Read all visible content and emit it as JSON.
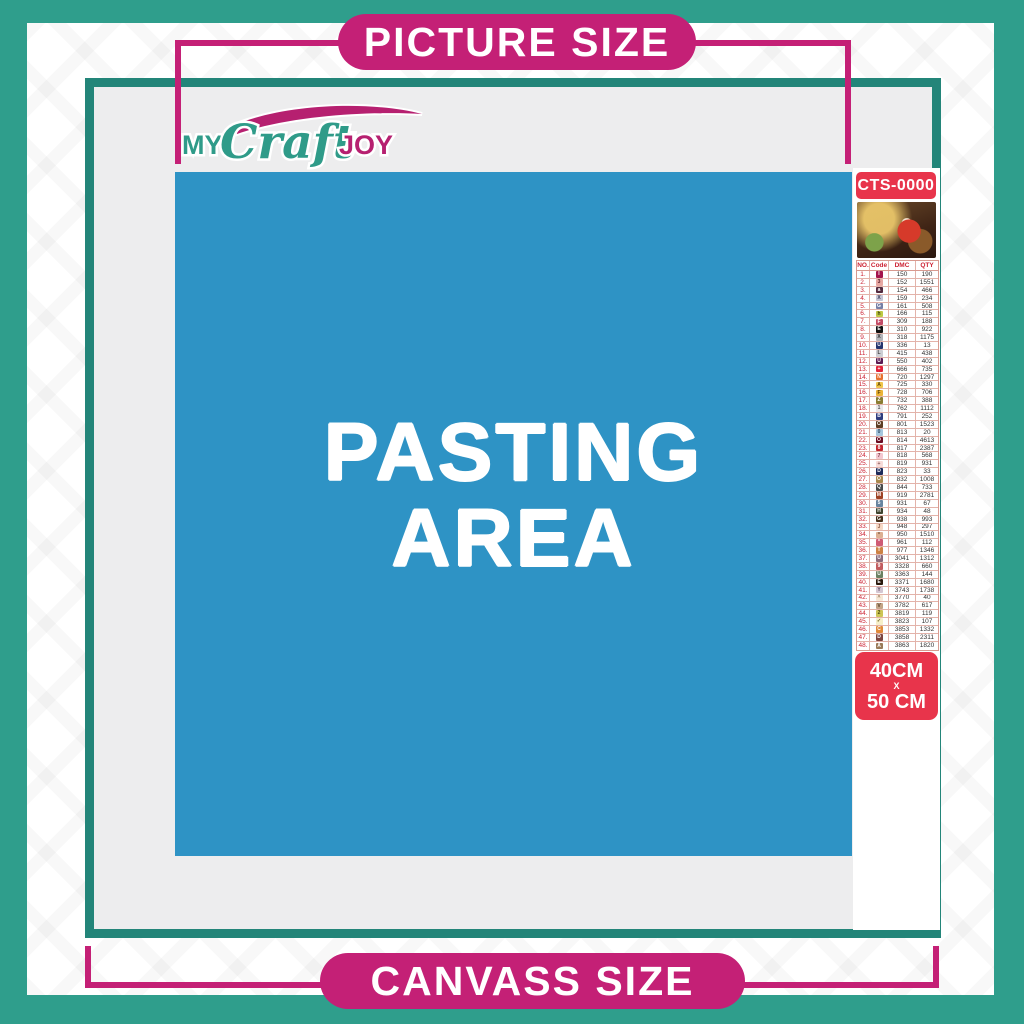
{
  "banners": {
    "top": "PICTURE SIZE",
    "bottom": "CANVASS SIZE"
  },
  "logo": {
    "word1": "MY",
    "word2": "Craft",
    "word3": "JOY"
  },
  "pasting_area": {
    "line1": "PASTING",
    "line2": "AREA"
  },
  "sidebar": {
    "product_code": "CTS-0000",
    "thumbnail": "santa-christmas-scene",
    "size_badge": {
      "line1": "40CM",
      "line2": "X",
      "line3": "50 CM"
    },
    "table": {
      "headers": [
        "NO.",
        "Code",
        "DMC",
        "QTY"
      ],
      "rows": [
        {
          "no": "1.",
          "symbol": "I",
          "cell_bg": "#a3154d",
          "sym_color": "#ffffff",
          "dmc": "150",
          "qty": "190"
        },
        {
          "no": "2.",
          "symbol": "3",
          "cell_bg": "#e8a7a2",
          "sym_color": "#5a2430",
          "dmc": "152",
          "qty": "1551"
        },
        {
          "no": "3.",
          "symbol": "a",
          "cell_bg": "#532a3f",
          "sym_color": "#ffffff",
          "dmc": "154",
          "qty": "466"
        },
        {
          "no": "4.",
          "symbol": "X",
          "cell_bg": "#c5c4d4",
          "sym_color": "#3a3a55",
          "dmc": "159",
          "qty": "234"
        },
        {
          "no": "5.",
          "symbol": "G",
          "cell_bg": "#767fa6",
          "sym_color": "#ffffff",
          "dmc": "161",
          "qty": "508"
        },
        {
          "no": "6.",
          "symbol": "h",
          "cell_bg": "#bec944",
          "sym_color": "#3c4010",
          "dmc": "166",
          "qty": "115"
        },
        {
          "no": "7.",
          "symbol": "F",
          "cell_bg": "#c34a65",
          "sym_color": "#ffffff",
          "dmc": "309",
          "qty": "188"
        },
        {
          "no": "8.",
          "symbol": "E",
          "cell_bg": "#111111",
          "sym_color": "#ffffff",
          "dmc": "310",
          "qty": "922"
        },
        {
          "no": "9.",
          "symbol": "X",
          "cell_bg": "#b3b3b8",
          "sym_color": "#333333",
          "dmc": "318",
          "qty": "1175"
        },
        {
          "no": "10.",
          "symbol": "U",
          "cell_bg": "#24356e",
          "sym_color": "#ffffff",
          "dmc": "336",
          "qty": "13"
        },
        {
          "no": "11.",
          "symbol": "L",
          "cell_bg": "#cdced3",
          "sym_color": "#444444",
          "dmc": "415",
          "qty": "438"
        },
        {
          "no": "12.",
          "symbol": "U",
          "cell_bg": "#5b1a52",
          "sym_color": "#ffffff",
          "dmc": "550",
          "qty": "402"
        },
        {
          "no": "13.",
          "symbol": "+",
          "cell_bg": "#e22339",
          "sym_color": "#ffffff",
          "dmc": "666",
          "qty": "735"
        },
        {
          "no": "14.",
          "symbol": "N",
          "cell_bg": "#e8702f",
          "sym_color": "#ffffff",
          "dmc": "720",
          "qty": "1297"
        },
        {
          "no": "15.",
          "symbol": "A",
          "cell_bg": "#f0c54b",
          "sym_color": "#5a430a",
          "dmc": "725",
          "qty": "330"
        },
        {
          "no": "16.",
          "symbol": "F",
          "cell_bg": "#ecb338",
          "sym_color": "#5a430a",
          "dmc": "728",
          "qty": "706"
        },
        {
          "no": "17.",
          "symbol": "Z",
          "cell_bg": "#8a7d33",
          "sym_color": "#ffffff",
          "dmc": "732",
          "qty": "388"
        },
        {
          "no": "18.",
          "symbol": "1",
          "cell_bg": "#e9e7ea",
          "sym_color": "#555555",
          "dmc": "762",
          "qty": "1112"
        },
        {
          "no": "19.",
          "symbol": "B",
          "cell_bg": "#2f3c7e",
          "sym_color": "#ffffff",
          "dmc": "791",
          "qty": "252"
        },
        {
          "no": "20.",
          "symbol": "O",
          "cell_bg": "#5e3d24",
          "sym_color": "#ffffff",
          "dmc": "801",
          "qty": "1523"
        },
        {
          "no": "21.",
          "symbol": "0",
          "cell_bg": "#a6c6dd",
          "sym_color": "#2d4a63",
          "dmc": "813",
          "qty": "20"
        },
        {
          "no": "22.",
          "symbol": "O",
          "cell_bg": "#6b0c22",
          "sym_color": "#ffffff",
          "dmc": "814",
          "qty": "4613"
        },
        {
          "no": "23.",
          "symbol": "8",
          "cell_bg": "#c2242e",
          "sym_color": "#ffffff",
          "dmc": "817",
          "qty": "2387"
        },
        {
          "no": "24.",
          "symbol": "7",
          "cell_bg": "#f3c7cf",
          "sym_color": "#7c3a49",
          "dmc": "818",
          "qty": "568"
        },
        {
          "no": "25.",
          "symbol": "+",
          "cell_bg": "#f7dbd8",
          "sym_color": "#8a5a57",
          "dmc": "819",
          "qty": "931"
        },
        {
          "no": "26.",
          "symbol": "D",
          "cell_bg": "#1d2a59",
          "sym_color": "#ffffff",
          "dmc": "823",
          "qty": "33"
        },
        {
          "no": "27.",
          "symbol": "O",
          "cell_bg": "#a8894e",
          "sym_color": "#ffffff",
          "dmc": "832",
          "qty": "1008"
        },
        {
          "no": "28.",
          "symbol": "Q",
          "cell_bg": "#4a4a4a",
          "sym_color": "#ffffff",
          "dmc": "844",
          "qty": "733"
        },
        {
          "no": "29.",
          "symbol": "M",
          "cell_bg": "#9e4123",
          "sym_color": "#ffffff",
          "dmc": "919",
          "qty": "2781"
        },
        {
          "no": "30.",
          "symbol": "5",
          "cell_bg": "#68849f",
          "sym_color": "#ffffff",
          "dmc": "931",
          "qty": "67"
        },
        {
          "no": "31.",
          "symbol": "H",
          "cell_bg": "#3f4430",
          "sym_color": "#ffffff",
          "dmc": "934",
          "qty": "48"
        },
        {
          "no": "32.",
          "symbol": "G",
          "cell_bg": "#46301c",
          "sym_color": "#ffffff",
          "dmc": "938",
          "qty": "993"
        },
        {
          "no": "33.",
          "symbol": "J",
          "cell_bg": "#f6d7c4",
          "sym_color": "#8a5a45",
          "dmc": "948",
          "qty": "297"
        },
        {
          "no": "34.",
          "symbol": "*",
          "cell_bg": "#ddb093",
          "sym_color": "#6b4a34",
          "dmc": "950",
          "qty": "1510"
        },
        {
          "no": "35.",
          "symbol": "*",
          "cell_bg": "#cf5b74",
          "sym_color": "#ffffff",
          "dmc": "961",
          "qty": "112"
        },
        {
          "no": "36.",
          "symbol": "T",
          "cell_bg": "#cd8244",
          "sym_color": "#ffffff",
          "dmc": "977",
          "qty": "1346"
        },
        {
          "no": "37.",
          "symbol": "U",
          "cell_bg": "#8a6b7b",
          "sym_color": "#ffffff",
          "dmc": "3041",
          "qty": "1312"
        },
        {
          "no": "38.",
          "symbol": "9",
          "cell_bg": "#c25b5e",
          "sym_color": "#ffffff",
          "dmc": "3328",
          "qty": "660"
        },
        {
          "no": "39.",
          "symbol": "U",
          "cell_bg": "#6b8162",
          "sym_color": "#ffffff",
          "dmc": "3363",
          "qty": "144"
        },
        {
          "no": "40.",
          "symbol": "E",
          "cell_bg": "#2a190d",
          "sym_color": "#ffffff",
          "dmc": "3371",
          "qty": "1680"
        },
        {
          "no": "41.",
          "symbol": "Y",
          "cell_bg": "#d4c6d2",
          "sym_color": "#5d4a5e",
          "dmc": "3743",
          "qty": "1738"
        },
        {
          "no": "42.",
          "symbol": "^",
          "cell_bg": "#f6e7d5",
          "sym_color": "#8a6b4a",
          "dmc": "3770",
          "qty": "40"
        },
        {
          "no": "43.",
          "symbol": "V",
          "cell_bg": "#c3a487",
          "sym_color": "#55402a",
          "dmc": "3782",
          "qty": "617"
        },
        {
          "no": "44.",
          "symbol": "2",
          "cell_bg": "#cdc556",
          "sym_color": "#4a4a10",
          "dmc": "3819",
          "qty": "119"
        },
        {
          "no": "45.",
          "symbol": "✓",
          "cell_bg": "#f7efc9",
          "sym_color": "#6b6020",
          "dmc": "3823",
          "qty": "107"
        },
        {
          "no": "46.",
          "symbol": "C",
          "cell_bg": "#e08a3a",
          "sym_color": "#ffffff",
          "dmc": "3853",
          "qty": "1332"
        },
        {
          "no": "47.",
          "symbol": "D",
          "cell_bg": "#7d4540",
          "sym_color": "#ffffff",
          "dmc": "3858",
          "qty": "2311"
        },
        {
          "no": "48.",
          "symbol": "A",
          "cell_bg": "#9a7a58",
          "sym_color": "#ffffff",
          "dmc": "3863",
          "qty": "1820"
        }
      ]
    }
  },
  "colors": {
    "outer_teal": "#2f9e8c",
    "frame_teal": "#238579",
    "magenta": "#c42076",
    "pasting_blue": "#2e93c5",
    "badge_red": "#e8344b",
    "canvas_gray": "#ededee"
  }
}
